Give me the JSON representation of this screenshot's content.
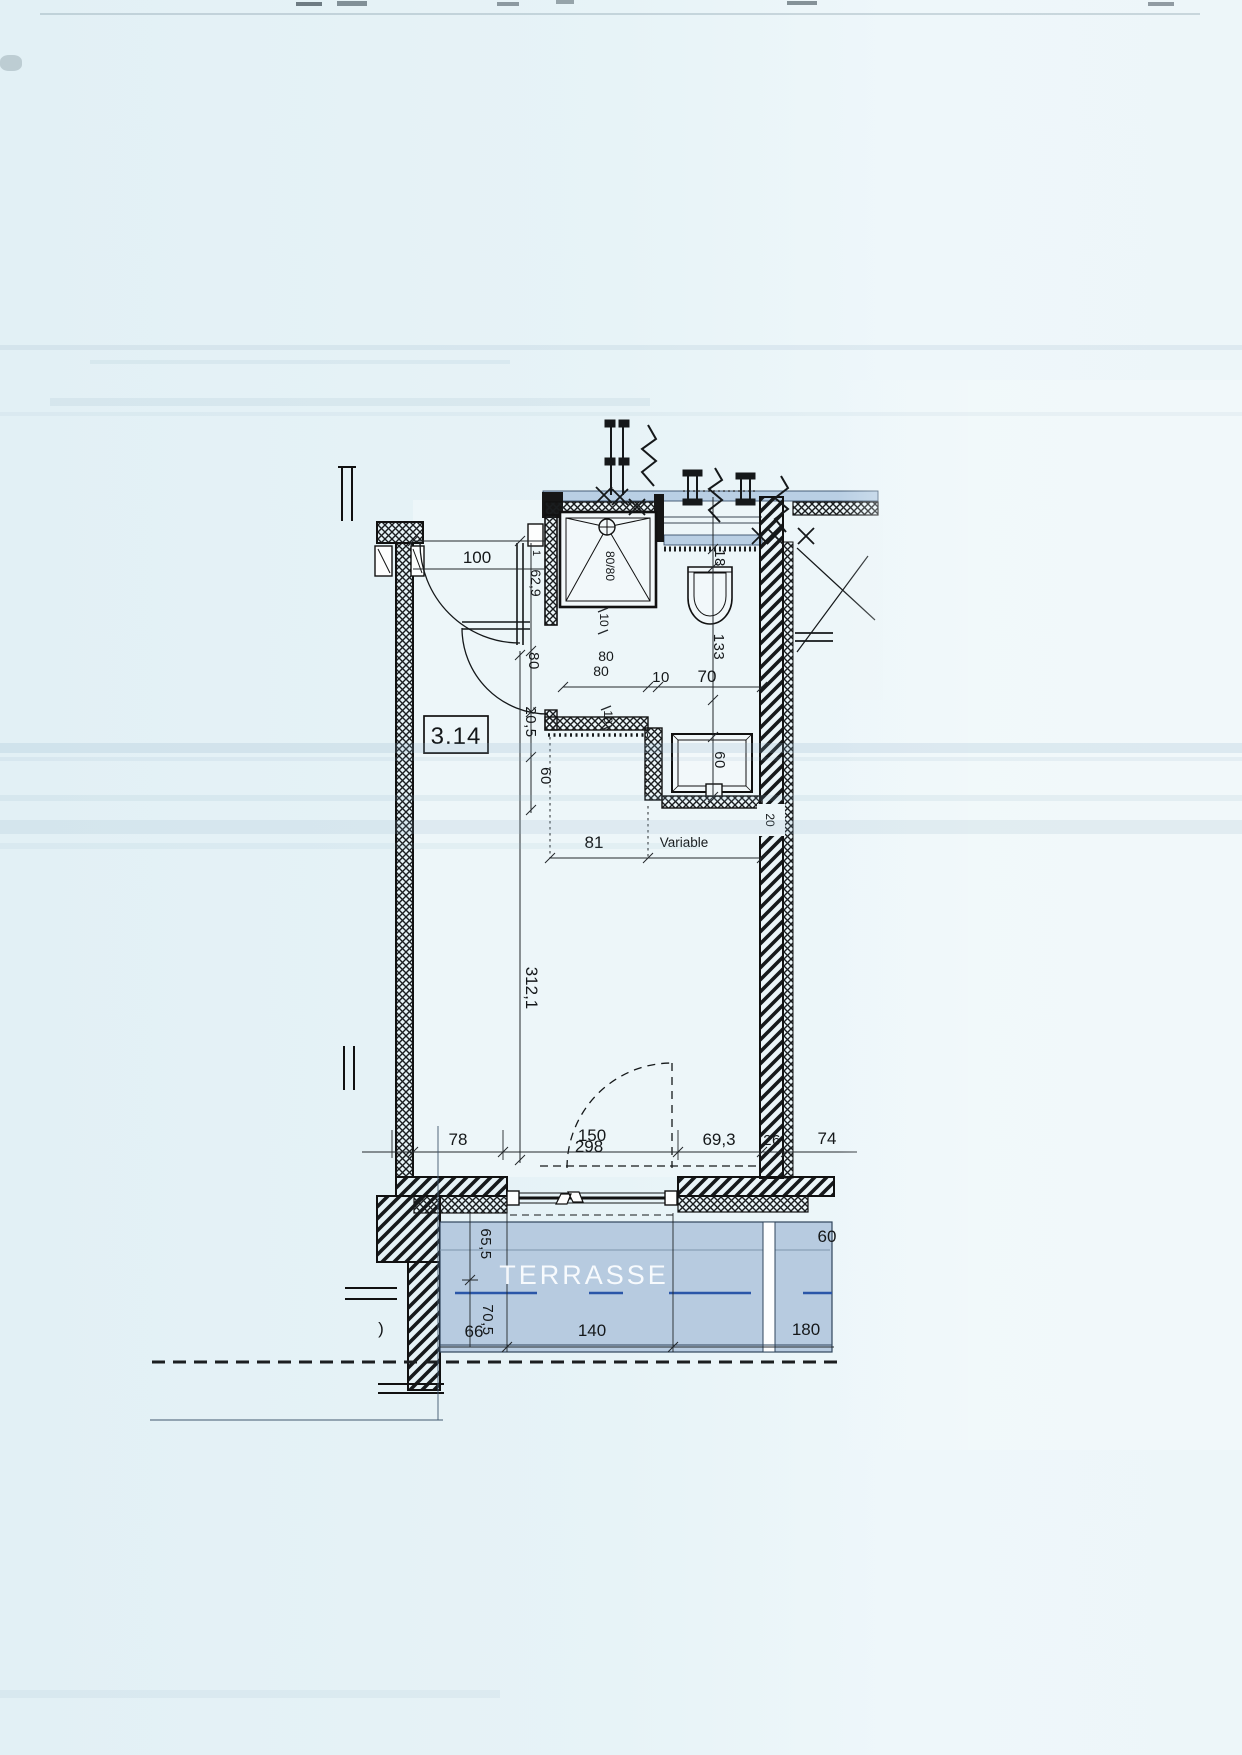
{
  "plan": {
    "room_label": "3.14",
    "terrace_label": "TERRASSE",
    "colors": {
      "paper": "#e7f3f7",
      "wall_band_blue": "#b9cfe4",
      "terrace_blue": "#b7cbe0",
      "terrace_dash_blue": "#2a56a8",
      "ink": "#15181a"
    },
    "dims": {
      "entry_width": "100",
      "entry_joint": "1",
      "entry_offset": "62,9",
      "bath_door_width": "80",
      "door_step": "20,5",
      "hall_depth": "60",
      "shower_size": "80/80",
      "shower_offset": "10",
      "shower_width_a": "80",
      "shower_width_b": "80",
      "wc_gap": "10",
      "wc_width": "70",
      "wall_band": "18",
      "wc_length": "133",
      "wall_step": "10",
      "basin_niche": "60",
      "bath_width": "81",
      "bath_variable": "Variable",
      "room_length": "312,1",
      "wall_thickness": "20",
      "bottom_78": "78",
      "bottom_150": "150",
      "bottom_298": "298",
      "bottom_69_3": "69,3",
      "bottom_26": "26",
      "bottom_74": "74",
      "terrace_65_5": "65,5",
      "terrace_70_5": "70,5",
      "terrace_66": "66",
      "terrace_140": "140",
      "terrace_180": "180",
      "terrace_60": "60",
      "terrace_cutoff": ")"
    }
  }
}
